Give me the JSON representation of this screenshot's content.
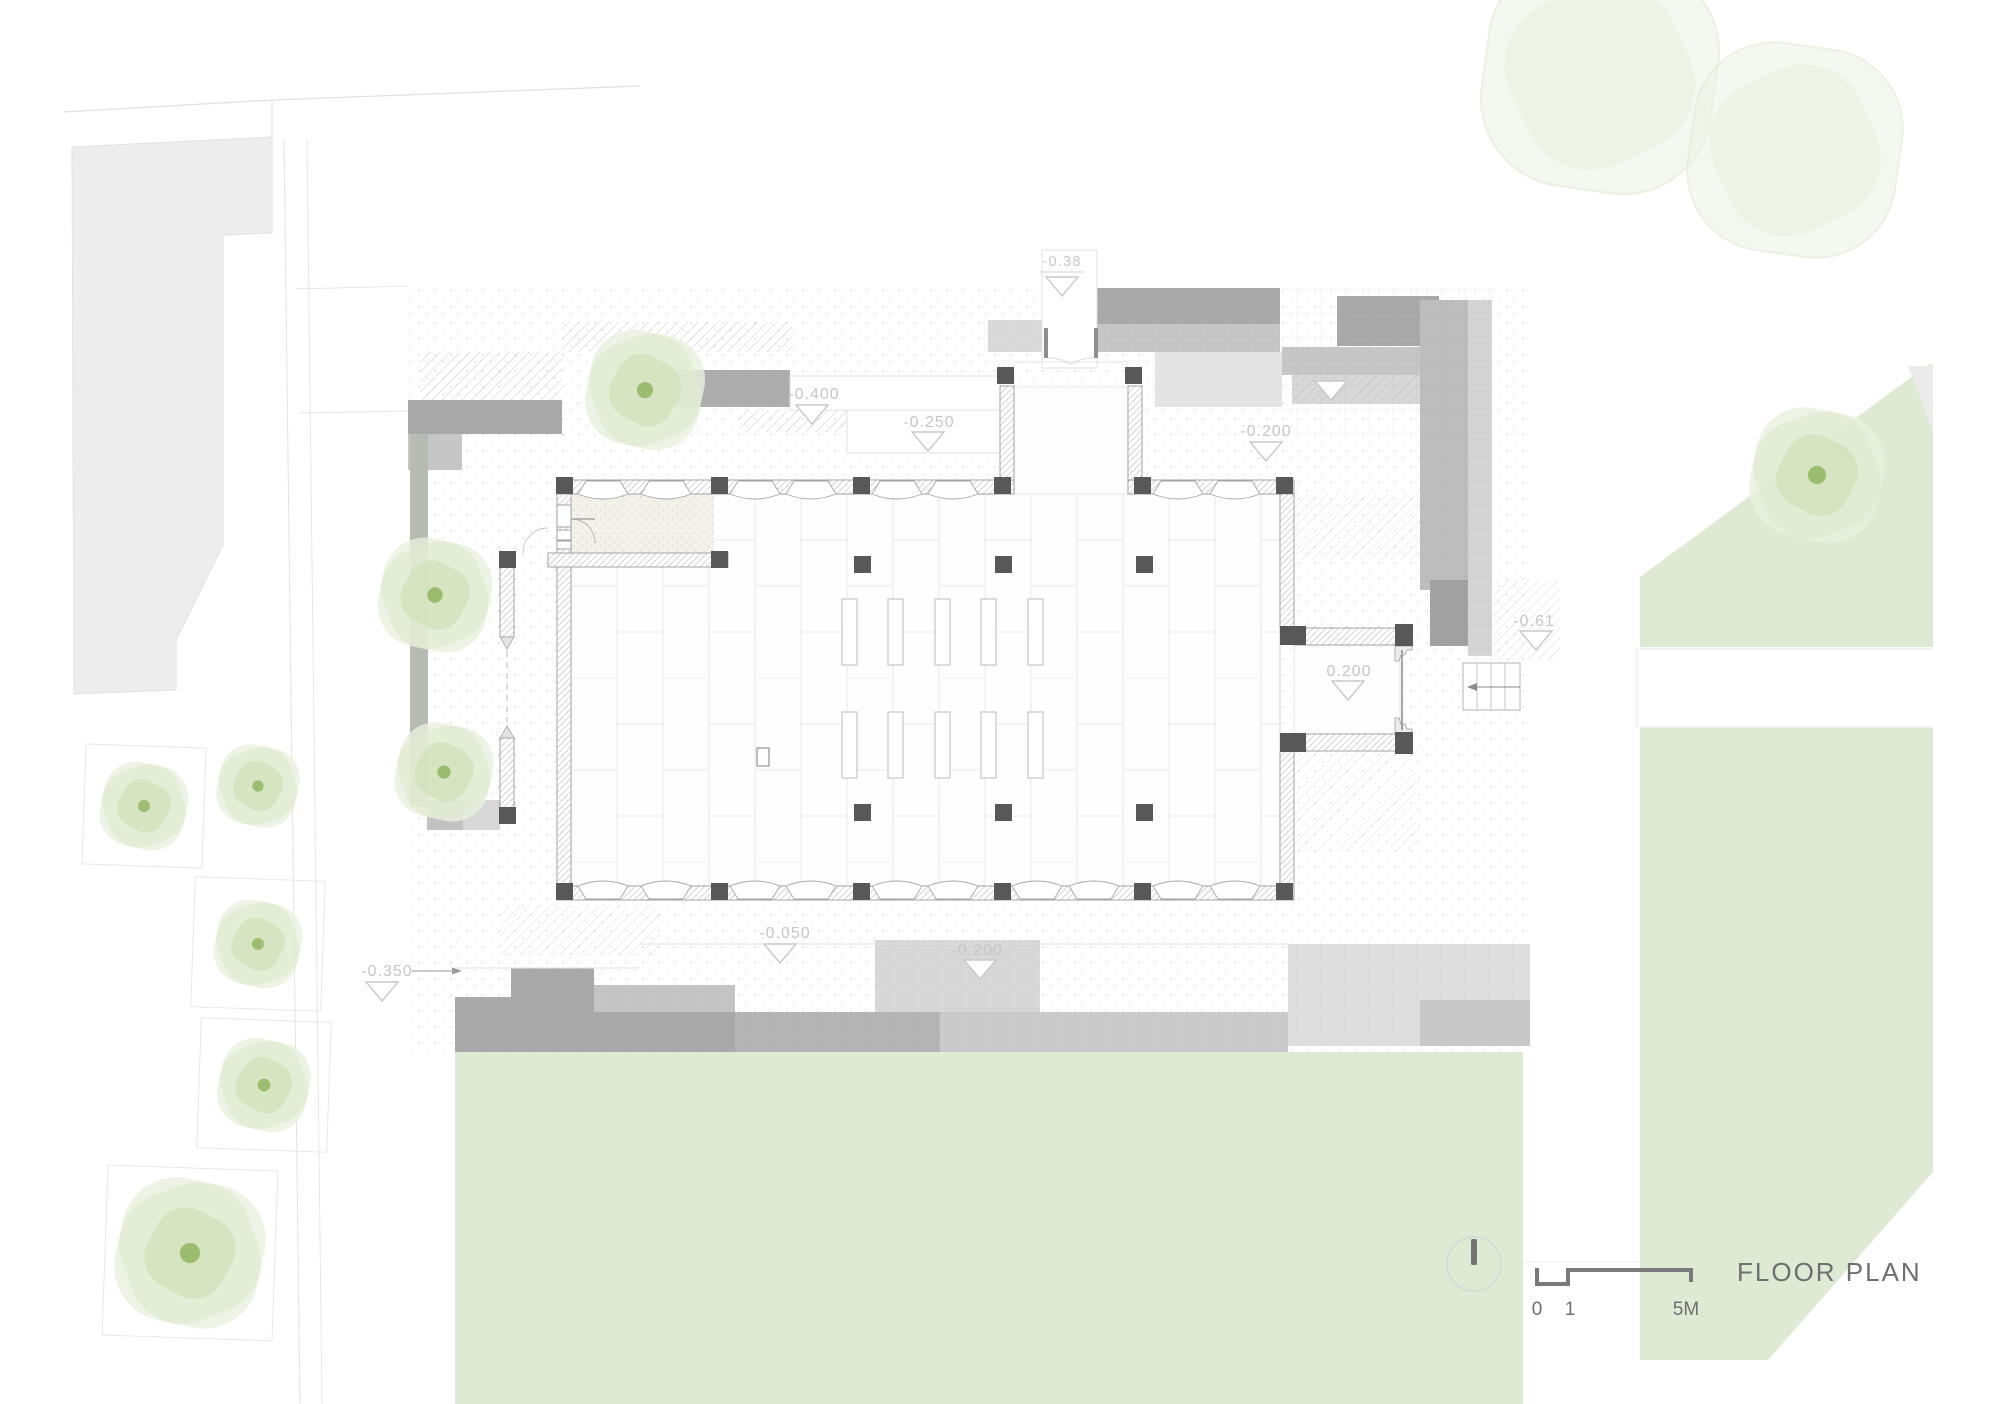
{
  "meta": {
    "drawing_title": "FLOOR PLAN"
  },
  "scale_bar": {
    "tick_0": "0",
    "tick_1": "1",
    "tick_5m": "5M"
  },
  "level_markers": {
    "north_entry_path": "-0.38",
    "northeast_upper_terrace": "-0.050",
    "northeast_plaza": "-0.200",
    "northwest_terrace": "-0.400",
    "north_terrace": "-0.250",
    "east_forecourt": "-0.61",
    "east_vestibule": "0.200",
    "south_terrace": "-0.050",
    "south_plaza": "-0.200",
    "southwest_walkway": "-0.350"
  },
  "colors": {
    "lawn_green": "#dfead4",
    "tree_green": "#d3e2bd",
    "tree_center": "#9cbd70",
    "paving_dark": "#a9a9a9",
    "paving_mid": "#c6c6c6",
    "paving_light": "#dedede",
    "wall_dark": "#585858",
    "annotation_grey": "#c6c6c6",
    "title_grey": "#6f6f6f"
  }
}
